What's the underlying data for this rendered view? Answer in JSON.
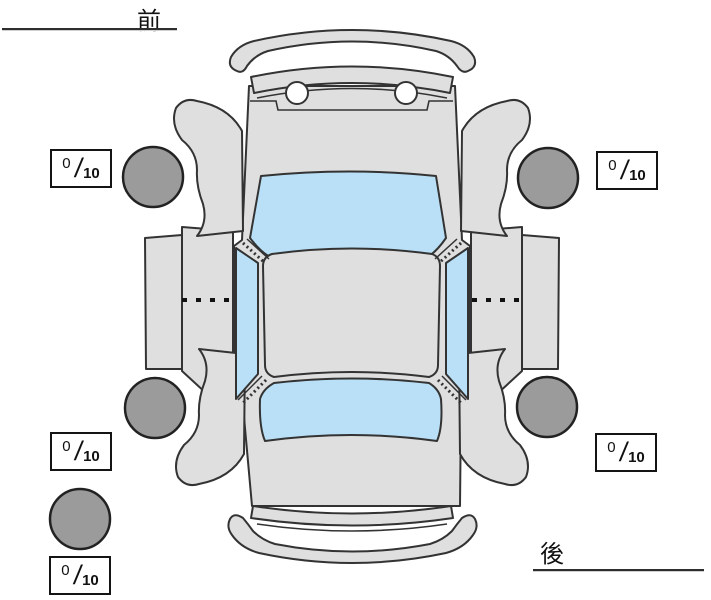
{
  "labels": {
    "front": "前",
    "rear": "後"
  },
  "ratings": {
    "front_left": {
      "value": "0",
      "max": "10"
    },
    "front_right": {
      "value": "0",
      "max": "10"
    },
    "rear_left": {
      "value": "0",
      "max": "10"
    },
    "rear_right": {
      "value": "0",
      "max": "10"
    },
    "spare": {
      "value": "0",
      "max": "10"
    }
  },
  "separator": "/",
  "colors": {
    "body_fill": "#dfdfdf",
    "window_fill": "#b9e0f6",
    "tire_fill": "#9b9b9b",
    "outline": "#333333",
    "tire_outline": "#222222"
  },
  "diagram": {
    "type": "car-top-view-condition-diagram",
    "tires": [
      "front-left",
      "front-right",
      "rear-left",
      "rear-right",
      "spare"
    ]
  }
}
